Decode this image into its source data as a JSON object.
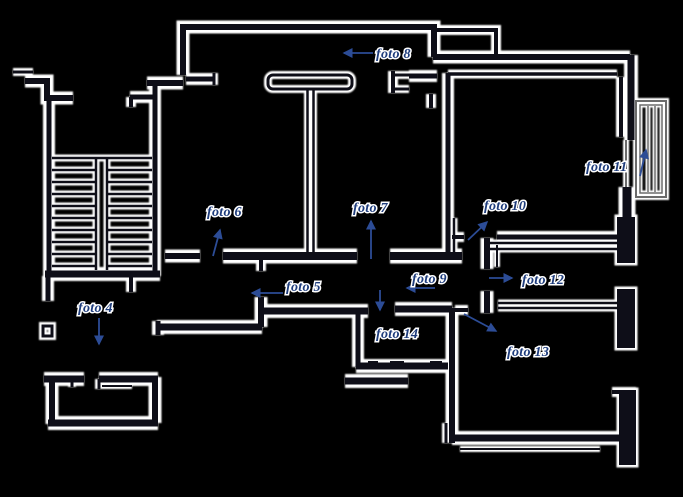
{
  "colors": {
    "background": "#000000",
    "ink": "#0e0e18",
    "halo": "#ffffff",
    "label": "#1e3c7c",
    "arrow": "#2c4c96",
    "thin": "#6b6b6b"
  },
  "labels": {
    "foto4": {
      "text": "foto 4",
      "arrow_direction": "down"
    },
    "foto5": {
      "text": "foto 5",
      "arrow_direction": "left"
    },
    "foto6": {
      "text": "foto 6",
      "arrow_direction": "up"
    },
    "foto7": {
      "text": "foto 7",
      "arrow_direction": "up"
    },
    "foto8": {
      "text": "foto 8",
      "arrow_direction": "left"
    },
    "foto9": {
      "text": "foto 9",
      "arrow_direction": "left"
    },
    "foto10": {
      "text": "foto 10",
      "arrow_direction": "up-right"
    },
    "foto11": {
      "text": "foto 11",
      "arrow_direction": "up"
    },
    "foto12": {
      "text": "foto 12",
      "arrow_direction": "right"
    },
    "foto13": {
      "text": "foto 13",
      "arrow_direction": "down-right"
    },
    "foto14": {
      "text": "foto 14",
      "arrow_direction": "down"
    }
  }
}
